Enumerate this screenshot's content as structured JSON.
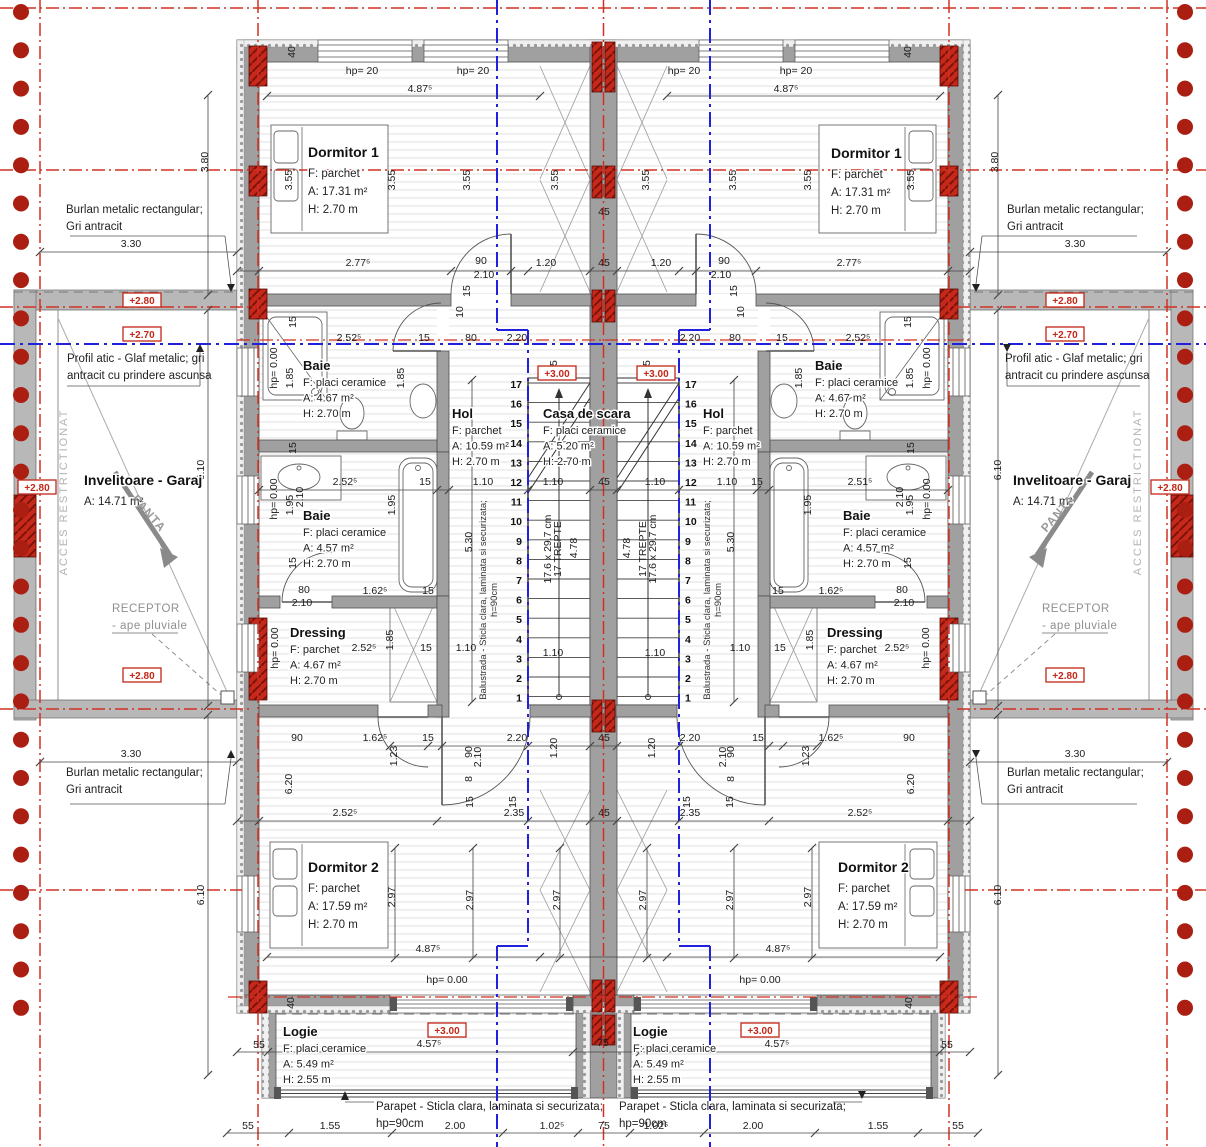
{
  "drawing_type": "architectural floor plan (duplex, mirrored units)",
  "colors": {
    "wall_grey": "#a0a0a0",
    "slab_grey": "#b8b8b8",
    "pillar_red": "#c6281a",
    "axis_red": "#d03022",
    "axis_blue": "#2020dd",
    "boundary_dot_red": "#ab1f12",
    "hatch_line": "#e2e2e2",
    "text_dark": "#1c1c1c",
    "grey_note": "#8f8f8f"
  },
  "rooms": [
    {
      "name": "Dormitor 1",
      "lines": [
        "F: parchet",
        "A: 17.31 m²",
        "H: 2.70 m"
      ],
      "x": 308,
      "y": 157,
      "sm": false
    },
    {
      "name": "Dormitor 1",
      "lines": [
        "F: parchet",
        "A: 17.31 m²",
        "H: 2.70 m"
      ],
      "x": 831,
      "y": 158,
      "sm": false
    },
    {
      "name": "Baie",
      "lines": [
        "F: placi ceramice",
        "A: 4.67 m²",
        "H: 2.70 m"
      ],
      "x": 303,
      "y": 370,
      "sm": true
    },
    {
      "name": "Baie",
      "lines": [
        "F: placi ceramice",
        "A: 4.67 m²",
        "H: 2.70 m"
      ],
      "x": 815,
      "y": 370,
      "sm": true
    },
    {
      "name": "Hol",
      "lines": [
        "F: parchet",
        "A: 10.59 m²",
        "H: 2.70 m"
      ],
      "x": 452,
      "y": 418,
      "sm": true
    },
    {
      "name": "Casa de scara",
      "lines": [
        "F: placi ceramice",
        "A: 5.20 m²",
        "H: 2.70 m"
      ],
      "x": 543,
      "y": 418,
      "sm": true
    },
    {
      "name": "Hol",
      "lines": [
        "F: parchet",
        "A: 10.59 m²",
        "H: 2.70 m"
      ],
      "x": 703,
      "y": 418,
      "sm": true
    },
    {
      "name": "Baie",
      "lines": [
        "F: placi ceramice",
        "A: 4.57 m²",
        "H: 2.70 m"
      ],
      "x": 303,
      "y": 520,
      "sm": true
    },
    {
      "name": "Baie",
      "lines": [
        "F: placi ceramice",
        "A: 4.57 m²",
        "H: 2.70 m"
      ],
      "x": 843,
      "y": 520,
      "sm": true
    },
    {
      "name": "Dressing",
      "lines": [
        "F: parchet",
        "A: 4.67 m²",
        "H: 2.70 m"
      ],
      "x": 290,
      "y": 637,
      "sm": true
    },
    {
      "name": "Dressing",
      "lines": [
        "F: parchet",
        "A: 4.67 m²",
        "H: 2.70 m"
      ],
      "x": 827,
      "y": 637,
      "sm": true
    },
    {
      "name": "Dormitor 2",
      "lines": [
        "F: parchet",
        "A: 17.59 m²",
        "H: 2.70 m"
      ],
      "x": 308,
      "y": 872,
      "sm": false
    },
    {
      "name": "Dormitor 2",
      "lines": [
        "F: parchet",
        "A: 17.59 m²",
        "H: 2.70 m"
      ],
      "x": 838,
      "y": 872,
      "sm": false
    },
    {
      "name": "Logie",
      "lines": [
        "F: placi ceramice",
        "A: 5.49 m²",
        "H: 2.55 m"
      ],
      "x": 283,
      "y": 1036,
      "sm": true
    },
    {
      "name": "Logie",
      "lines": [
        "F: placi ceramice",
        "A: 5.49 m²",
        "H: 2.55 m"
      ],
      "x": 633,
      "y": 1036,
      "sm": true
    },
    {
      "name": "Invelitoare - Garaj",
      "lines": [
        "A: 14.71 m²"
      ],
      "x": 84,
      "y": 485,
      "sm": false
    },
    {
      "name": "Invelitoare - Garaj",
      "lines": [
        "A: 14.71 m²"
      ],
      "x": 1013,
      "y": 485,
      "sm": false
    }
  ],
  "stair": {
    "steps": [
      "1",
      "2",
      "3",
      "4",
      "5",
      "6",
      "7",
      "8",
      "9",
      "10",
      "11",
      "12",
      "13",
      "14",
      "15",
      "16",
      "17"
    ],
    "left_number_x": 522,
    "right_number_x": 685,
    "top_y": 387,
    "dy": 19.6,
    "tread_note": "17.6 x 29.7 cm",
    "tread_count_label": "17 TREPTE",
    "flight_length": "4.78"
  },
  "level_markers": [
    [
      "+2.80",
      142,
      303
    ],
    [
      "+2.70",
      142,
      337
    ],
    [
      "+2.80",
      37,
      490
    ],
    [
      "+2.80",
      142,
      678
    ],
    [
      "+2.80",
      1065,
      303
    ],
    [
      "+2.70",
      1065,
      337
    ],
    [
      "+2.80",
      1170,
      490
    ],
    [
      "+2.80",
      1065,
      678
    ],
    [
      "+3.00",
      557,
      376
    ],
    [
      "+3.00",
      656,
      376
    ],
    [
      "+3.00",
      447,
      1033
    ],
    [
      "+3.00",
      760,
      1033
    ]
  ],
  "annotations": [
    {
      "lines": [
        "Burlan metalic rectangular;",
        "Gri antracit"
      ],
      "x": 66,
      "y": 213,
      "grey": false
    },
    {
      "lines": [
        "Burlan metalic rectangular;",
        "Gri antracit"
      ],
      "x": 1007,
      "y": 213,
      "grey": false
    },
    {
      "lines": [
        "Burlan metalic rectangular;",
        "Gri antracit"
      ],
      "x": 66,
      "y": 776,
      "grey": false
    },
    {
      "lines": [
        "Burlan metalic rectangular;",
        "Gri antracit"
      ],
      "x": 1007,
      "y": 776,
      "grey": false
    },
    {
      "lines": [
        "Profil atic - Glaf metalic; gri",
        "antracit cu prindere ascunsa"
      ],
      "x": 67,
      "y": 362,
      "grey": false
    },
    {
      "lines": [
        "Profil atic - Glaf metalic; gri",
        "antracit cu prindere ascunsa"
      ],
      "x": 1005,
      "y": 362,
      "grey": false
    },
    {
      "lines": [
        "Parapet - Sticla clara, laminata si securizata;",
        "hp=90cm"
      ],
      "x": 376,
      "y": 1110,
      "grey": false
    },
    {
      "lines": [
        "Parapet - Sticla clara, laminata si securizata;",
        "hp=90cm"
      ],
      "x": 619,
      "y": 1110,
      "grey": false
    },
    {
      "lines": [
        "RECEPTOR",
        "- ape pluviale"
      ],
      "x": 112,
      "y": 612,
      "grey": true
    },
    {
      "lines": [
        "RECEPTOR",
        "- ape pluviale"
      ],
      "x": 1042,
      "y": 612,
      "grey": true
    }
  ],
  "rotated_labels": [
    [
      "ACCES RESTRICTIONAT",
      67,
      492,
      -90,
      "acces"
    ],
    [
      "ACCES RESTRICTIONAT",
      1141,
      492,
      -90,
      "acces"
    ],
    [
      "PANTA",
      146,
      516,
      49,
      "panta"
    ],
    [
      "PANTA",
      1061,
      516,
      -49,
      "panta"
    ],
    [
      "Balustrada - Sticla clara, laminata si securizata;",
      486,
      600,
      -90,
      "balu"
    ],
    [
      "h=90cm",
      497,
      600,
      -90,
      "balu"
    ],
    [
      "Balustrada - Sticla clara, laminata si securizata;",
      710,
      600,
      -90,
      "balu"
    ],
    [
      "h=90cm",
      721,
      600,
      -90,
      "balu"
    ]
  ],
  "dimensions": [
    [
      "40",
      295,
      52,
      1
    ],
    [
      "40",
      911,
      52,
      1
    ],
    [
      "hp= 20",
      362,
      74,
      0
    ],
    [
      "hp= 20",
      473,
      74,
      0
    ],
    [
      "hp= 20",
      684,
      74,
      0
    ],
    [
      "hp= 20",
      796,
      74,
      0
    ],
    [
      "4.87⁵",
      420,
      92,
      0
    ],
    [
      "4.87⁵",
      786,
      92,
      0
    ],
    [
      "3.55",
      292,
      180,
      1
    ],
    [
      "3.55",
      395,
      180,
      1
    ],
    [
      "3.55",
      470,
      180,
      1
    ],
    [
      "3.55",
      558,
      180,
      1
    ],
    [
      "3.55",
      649,
      180,
      1
    ],
    [
      "3.55",
      736,
      180,
      1
    ],
    [
      "3.55",
      811,
      180,
      1
    ],
    [
      "3.55",
      914,
      180,
      1
    ],
    [
      "3.80",
      208,
      162,
      1
    ],
    [
      "3.80",
      998,
      162,
      1
    ],
    [
      "3.30",
      131,
      247,
      0
    ],
    [
      "3.30",
      1075,
      247,
      0
    ],
    [
      "45",
      604,
      215,
      0
    ],
    [
      "2.77⁵",
      358,
      266,
      0
    ],
    [
      "2.77⁵",
      849,
      266,
      0
    ],
    [
      "90",
      481,
      264,
      0
    ],
    [
      "90",
      724,
      264,
      0
    ],
    [
      "2.10",
      484,
      278,
      0
    ],
    [
      "2.10",
      721,
      278,
      0
    ],
    [
      "1.20",
      546,
      266,
      0
    ],
    [
      "1.20",
      661,
      266,
      0
    ],
    [
      "45",
      604,
      266,
      0
    ],
    [
      "15",
      470,
      291,
      1
    ],
    [
      "15",
      737,
      291,
      1
    ],
    [
      "10",
      463,
      312,
      1
    ],
    [
      "10",
      744,
      312,
      1
    ],
    [
      "15",
      296,
      322,
      1
    ],
    [
      "15",
      911,
      322,
      1
    ],
    [
      "2.52⁵",
      349,
      341,
      0
    ],
    [
      "15",
      424,
      341,
      0
    ],
    [
      "80",
      471,
      341,
      0
    ],
    [
      "2.20",
      517,
      341,
      0
    ],
    [
      "2.20",
      690,
      341,
      0
    ],
    [
      "80",
      735,
      341,
      0
    ],
    [
      "15",
      782,
      341,
      0
    ],
    [
      "2.52⁵",
      858,
      341,
      0
    ],
    [
      "hp= 0.00",
      277,
      368,
      1
    ],
    [
      "hp= 0.00",
      930,
      368,
      1
    ],
    [
      "1.85",
      293,
      378,
      1
    ],
    [
      "1.85",
      404,
      378,
      1
    ],
    [
      "1.85",
      802,
      378,
      1
    ],
    [
      "1.85",
      913,
      378,
      1
    ],
    [
      "15",
      557,
      366,
      1
    ],
    [
      "15",
      650,
      366,
      1
    ],
    [
      "15",
      296,
      448,
      1
    ],
    [
      "15",
      914,
      448,
      1
    ],
    [
      "2.52⁵",
      345,
      485,
      0
    ],
    [
      "15",
      425,
      485,
      0
    ],
    [
      "1.10",
      483,
      485,
      0
    ],
    [
      "1.10",
      553,
      485,
      0
    ],
    [
      "45",
      604,
      485,
      0
    ],
    [
      "1.10",
      655,
      485,
      0
    ],
    [
      "1.10",
      727,
      485,
      0
    ],
    [
      "15",
      757,
      485,
      0
    ],
    [
      "2.51⁵",
      860,
      485,
      0
    ],
    [
      "1.95",
      293,
      505,
      1
    ],
    [
      "1.95",
      395,
      505,
      1
    ],
    [
      "1.95",
      811,
      505,
      1
    ],
    [
      "1.95",
      913,
      505,
      1
    ],
    [
      "2.10",
      303,
      497,
      1
    ],
    [
      "2.10",
      903,
      497,
      1
    ],
    [
      "hp= 0.00",
      277,
      499,
      1
    ],
    [
      "hp= 0.00",
      930,
      499,
      1
    ],
    [
      "5.30",
      472,
      542,
      1
    ],
    [
      "5.30",
      734,
      542,
      1
    ],
    [
      "6.10",
      204,
      470,
      1
    ],
    [
      "6.10",
      1001,
      470,
      1
    ],
    [
      "15",
      296,
      563,
      1
    ],
    [
      "15",
      911,
      563,
      1
    ],
    [
      "17.6 x 29.7 cm",
      551,
      549,
      1
    ],
    [
      "17 TREPTE",
      561,
      549,
      1
    ],
    [
      "4.78",
      577,
      548,
      1
    ],
    [
      "4.78",
      630,
      548,
      1
    ],
    [
      "17 TREPTE",
      646,
      549,
      1
    ],
    [
      "17.6 x 29.7 cm",
      656,
      549,
      1
    ],
    [
      "1.10",
      553,
      656,
      0
    ],
    [
      "1.10",
      655,
      656,
      0
    ],
    [
      "80",
      304,
      593,
      0
    ],
    [
      "2.10",
      302,
      606,
      0
    ],
    [
      "1.62⁵",
      375,
      594,
      0
    ],
    [
      "15",
      428,
      594,
      0
    ],
    [
      "15",
      778,
      594,
      0
    ],
    [
      "1.62⁵",
      831,
      594,
      0
    ],
    [
      "80",
      902,
      593,
      0
    ],
    [
      "2.10",
      904,
      606,
      0
    ],
    [
      "2.52⁵",
      364,
      651,
      0
    ],
    [
      "15",
      426,
      651,
      0
    ],
    [
      "1.10",
      466,
      651,
      0
    ],
    [
      "1.10",
      740,
      651,
      0
    ],
    [
      "15",
      780,
      651,
      0
    ],
    [
      "2.52⁵",
      897,
      651,
      0
    ],
    [
      "1.85",
      393,
      640,
      1
    ],
    [
      "1.85",
      813,
      640,
      1
    ],
    [
      "hp= 0.00",
      278,
      648,
      1
    ],
    [
      "hp= 0.00",
      929,
      648,
      1
    ],
    [
      "90",
      297,
      741,
      0
    ],
    [
      "1.62⁵",
      375,
      741,
      0
    ],
    [
      "15",
      428,
      741,
      0
    ],
    [
      "2.20",
      517,
      741,
      0
    ],
    [
      "45",
      604,
      741,
      0
    ],
    [
      "2.20",
      690,
      741,
      0
    ],
    [
      "15",
      758,
      741,
      0
    ],
    [
      "1.62⁵",
      831,
      741,
      0
    ],
    [
      "90",
      909,
      741,
      0
    ],
    [
      "1.20",
      557,
      748,
      1
    ],
    [
      "1.20",
      655,
      748,
      1
    ],
    [
      "90",
      472,
      752,
      1
    ],
    [
      "2.10",
      481,
      757,
      1
    ],
    [
      "8",
      472,
      779,
      1
    ],
    [
      "90",
      734,
      752,
      1
    ],
    [
      "2.10",
      726,
      757,
      1
    ],
    [
      "8",
      734,
      779,
      1
    ],
    [
      "1.23",
      397,
      756,
      1
    ],
    [
      "1.23",
      809,
      756,
      1
    ],
    [
      "15",
      473,
      802,
      1
    ],
    [
      "15",
      516,
      802,
      1
    ],
    [
      "15",
      690,
      802,
      1
    ],
    [
      "15",
      733,
      802,
      1
    ],
    [
      "2.52⁵",
      345,
      816,
      0
    ],
    [
      "2.35",
      514,
      816,
      0
    ],
    [
      "45",
      604,
      816,
      0
    ],
    [
      "2.35",
      690,
      816,
      0
    ],
    [
      "2.52⁵",
      860,
      816,
      0
    ],
    [
      "6.20",
      292,
      784,
      1
    ],
    [
      "6.20",
      914,
      784,
      1
    ],
    [
      "3.30",
      131,
      757,
      0
    ],
    [
      "3.30",
      1075,
      757,
      0
    ],
    [
      "2.97",
      395,
      897,
      1
    ],
    [
      "2.97",
      473,
      900,
      1
    ],
    [
      "2.97",
      560,
      900,
      1
    ],
    [
      "2.97",
      646,
      900,
      1
    ],
    [
      "2.97",
      733,
      900,
      1
    ],
    [
      "2.97",
      811,
      897,
      1
    ],
    [
      "6.10",
      204,
      895,
      1
    ],
    [
      "6.10",
      1001,
      895,
      1
    ],
    [
      "4.87⁵",
      428,
      952,
      0
    ],
    [
      "4.87⁵",
      778,
      952,
      0
    ],
    [
      "hp= 0.00",
      447,
      983,
      0
    ],
    [
      "hp= 0.00",
      760,
      983,
      0
    ],
    [
      "40",
      294,
      1003,
      1
    ],
    [
      "40",
      912,
      1003,
      1
    ],
    [
      "55",
      259,
      1048,
      0
    ],
    [
      "4.57⁵",
      429,
      1047,
      0
    ],
    [
      "75",
      603,
      1046,
      0
    ],
    [
      "4.57⁵",
      777,
      1047,
      0
    ],
    [
      "55",
      947,
      1048,
      0
    ],
    [
      "55",
      248,
      1129,
      0
    ],
    [
      "1.55",
      330,
      1129,
      0
    ],
    [
      "2.00",
      455,
      1129,
      0
    ],
    [
      "1.02⁵",
      552,
      1129,
      0
    ],
    [
      "75",
      604,
      1129,
      0
    ],
    [
      "1.02⁵",
      656,
      1129,
      0
    ],
    [
      "2.00",
      753,
      1129,
      0
    ],
    [
      "1.55",
      878,
      1129,
      0
    ],
    [
      "55",
      958,
      1129,
      0
    ]
  ],
  "boundary": {
    "dot_count": 27,
    "left_x": 21,
    "right_x": 1185,
    "start_y": 12,
    "step": 38.3
  }
}
